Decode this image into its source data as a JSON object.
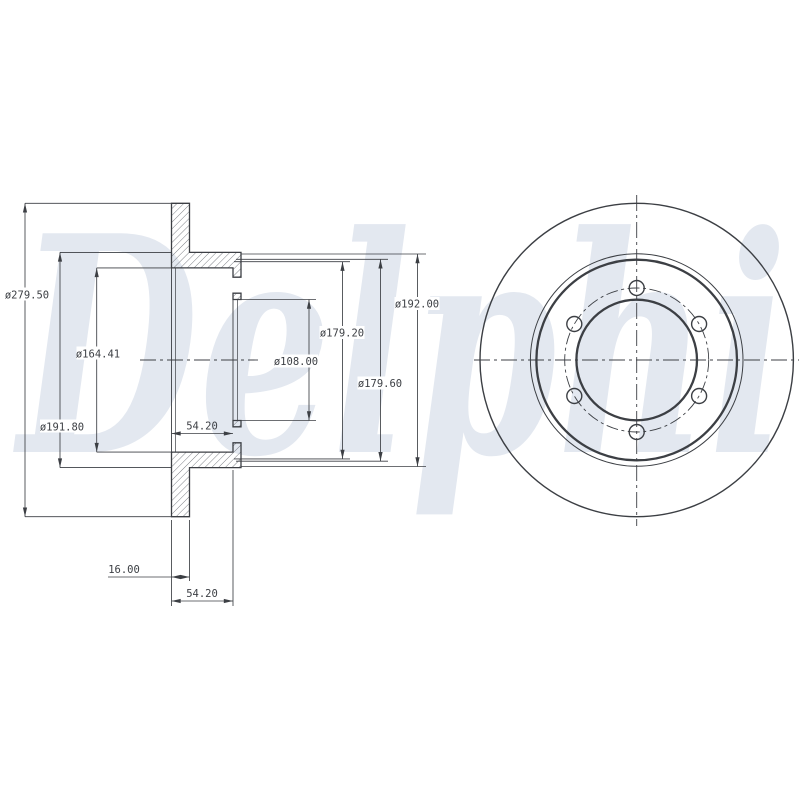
{
  "watermark": {
    "text": "Delphi"
  },
  "views": {
    "cross_section": {
      "dimensions": {
        "outer_diameter": "ø279.50",
        "ring_inner_diameter": "ø191.80",
        "hat_inner_diameter": "ø164.41",
        "hat_offset": "54.20",
        "centre_bore": "ø108.00",
        "hat_step_diameter": "ø179.20",
        "hat_register_diameter": "ø179.60",
        "hat_outer_diameter": "ø192.00",
        "disc_thickness": "16.00",
        "overall_height": "54.20"
      }
    },
    "front": {
      "bolt_hole_count": 6
    }
  },
  "colors": {
    "line": "#3c3f44",
    "hatch": "#555a61",
    "watermark": "#e3e8f0",
    "background": "#ffffff"
  }
}
